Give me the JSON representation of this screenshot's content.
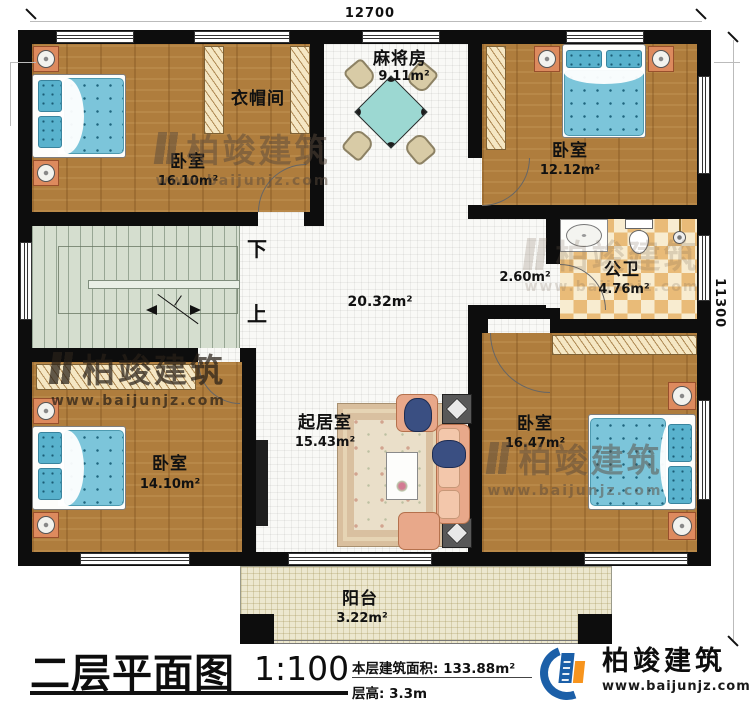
{
  "dimensions": {
    "width": "12700",
    "height": "11300"
  },
  "rooms": {
    "cloakroom": {
      "name": "衣帽间"
    },
    "bedroom_tl": {
      "name": "卧室",
      "area": "16.10m²"
    },
    "mahjong": {
      "name": "麻将房",
      "area": "9.11m²"
    },
    "bedroom_tr": {
      "name": "卧室",
      "area": "12.12m²"
    },
    "bathroom": {
      "name": "公卫",
      "area": "4.76m²"
    },
    "corridor": {
      "area": "2.60m²"
    },
    "hall": {
      "area": "20.32m²"
    },
    "bedroom_bl": {
      "name": "卧室",
      "area": "14.10m²"
    },
    "living": {
      "name": "起居室",
      "area": "15.43m²"
    },
    "bedroom_br": {
      "name": "卧室",
      "area": "16.47m²"
    },
    "balcony": {
      "name": "阳台",
      "area": "3.22m²"
    }
  },
  "stairs": {
    "down": "下",
    "up": "上"
  },
  "titleblock": {
    "title": "二层平面图",
    "scale": "1:100",
    "area_label": "本层建筑面积:",
    "area_value": "133.88m²",
    "height_label": "层高:",
    "height_value": "3.3m"
  },
  "brand": {
    "name": "柏竣建筑",
    "site": "www.baijunjz.com"
  },
  "watermark": {
    "text": "柏竣建筑",
    "site": "www.baijunjz.com"
  },
  "colors": {
    "wall": "#0d0d0d",
    "wood": "#af7d3d",
    "bed": "#7cc5da",
    "checker": "#e9bb78",
    "stairs": "#d5decf",
    "balcony": "#ece7cf",
    "brand_blue": "#1b5fa8",
    "brand_orange": "#f7941d"
  }
}
